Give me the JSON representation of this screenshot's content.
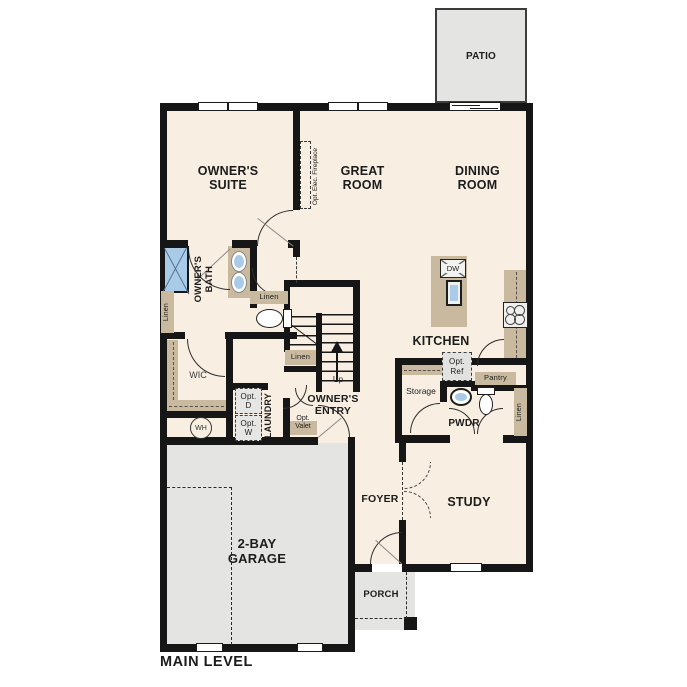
{
  "plan_title": "MAIN LEVEL",
  "colors": {
    "floor": "#f8eee1",
    "outdoor": "#e4e4e2",
    "wall": "#161616",
    "cabinet": "#c9b99f",
    "water": "#a9cbe8",
    "line": "#8a8a8a"
  },
  "rooms": {
    "patio": "PATIO",
    "owners_suite": "OWNER'S\nSUITE",
    "great_room": "GREAT\nROOM",
    "dining_room": "DINING\nROOM",
    "owners_bath": "OWNER'S\nBATH",
    "kitchen": "KITCHEN",
    "wic": "WIC",
    "laundry": "LAUNDRY",
    "owners_entry": "OWNER'S\nENTRY",
    "garage": "2-BAY\nGARAGE",
    "foyer": "FOYER",
    "study": "STUDY",
    "pwdr": "PWDR",
    "porch": "PORCH"
  },
  "annotations": {
    "up": "Up",
    "linen": "Linen",
    "pantry": "Pantry",
    "storage": "Storage",
    "opt_elec_fireplace": "Opt. Elec. Fireplace",
    "opt_ref": "Opt.\nRef",
    "opt_d": "Opt.\nD",
    "opt_w": "Opt.\nW",
    "opt_valet": "Opt.\nValet",
    "wh": "WH",
    "dw": "DW"
  }
}
